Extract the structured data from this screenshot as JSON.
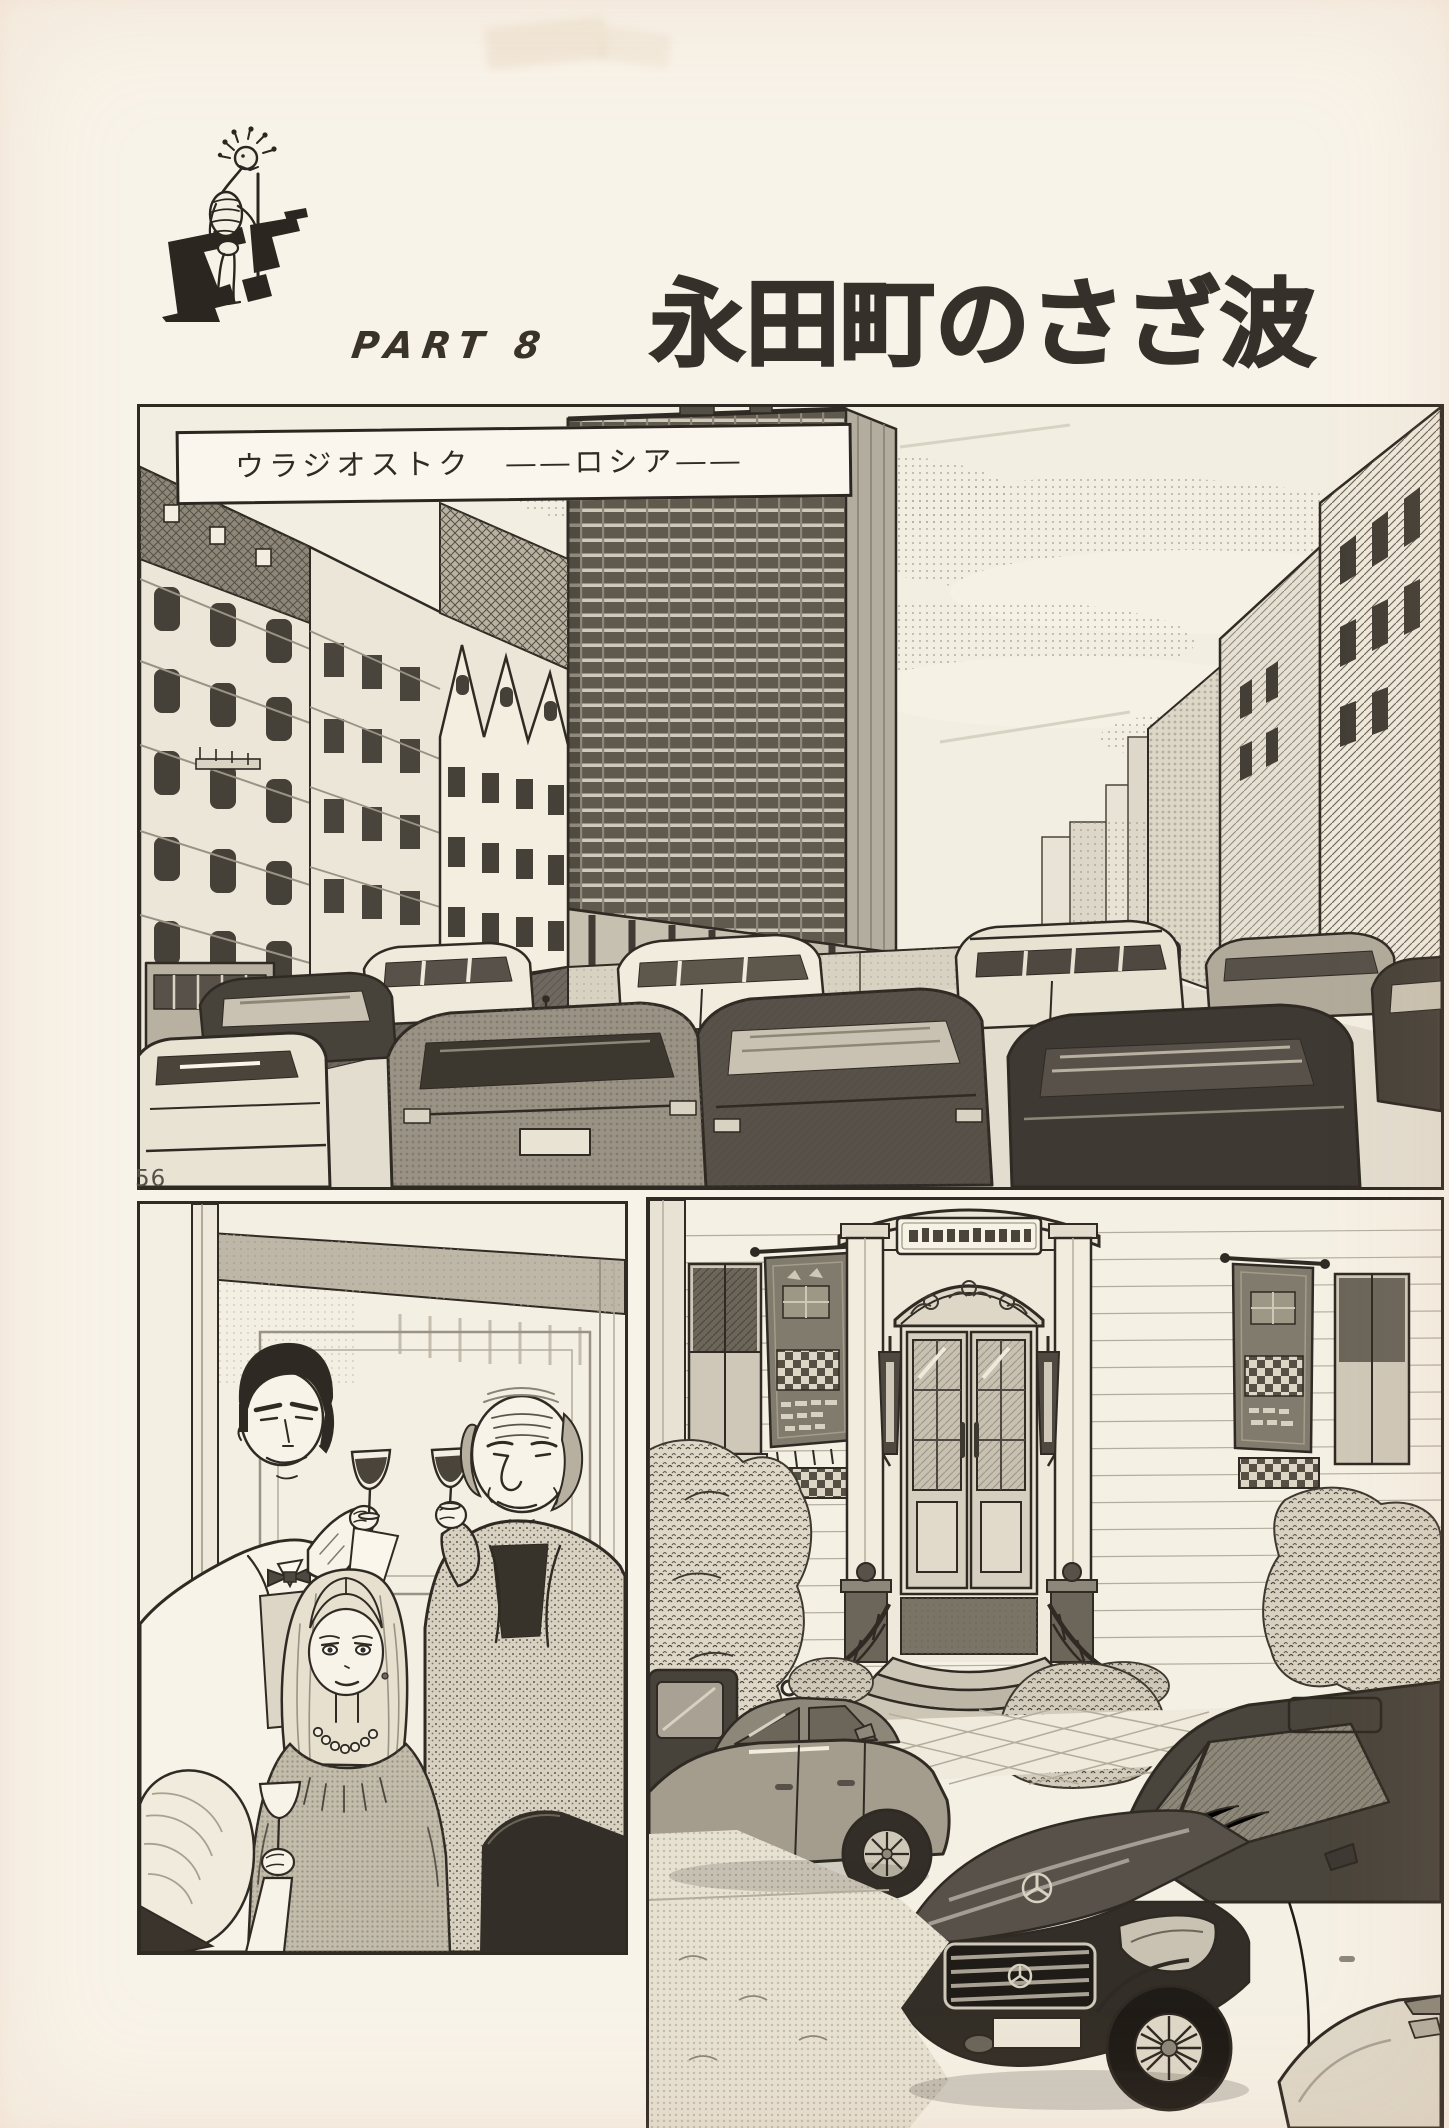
{
  "page": {
    "number": "56"
  },
  "header": {
    "part_label": "PART 8",
    "title": "永田町のさざ波"
  },
  "panel_city": {
    "caption": "ウラジオストク　――ロシア――"
  },
  "colors": {
    "paper": "#f8f3e9",
    "ink": "#2f2a23",
    "halftone_gray": "#9a9385",
    "caption_bg": "#faf6ee"
  }
}
